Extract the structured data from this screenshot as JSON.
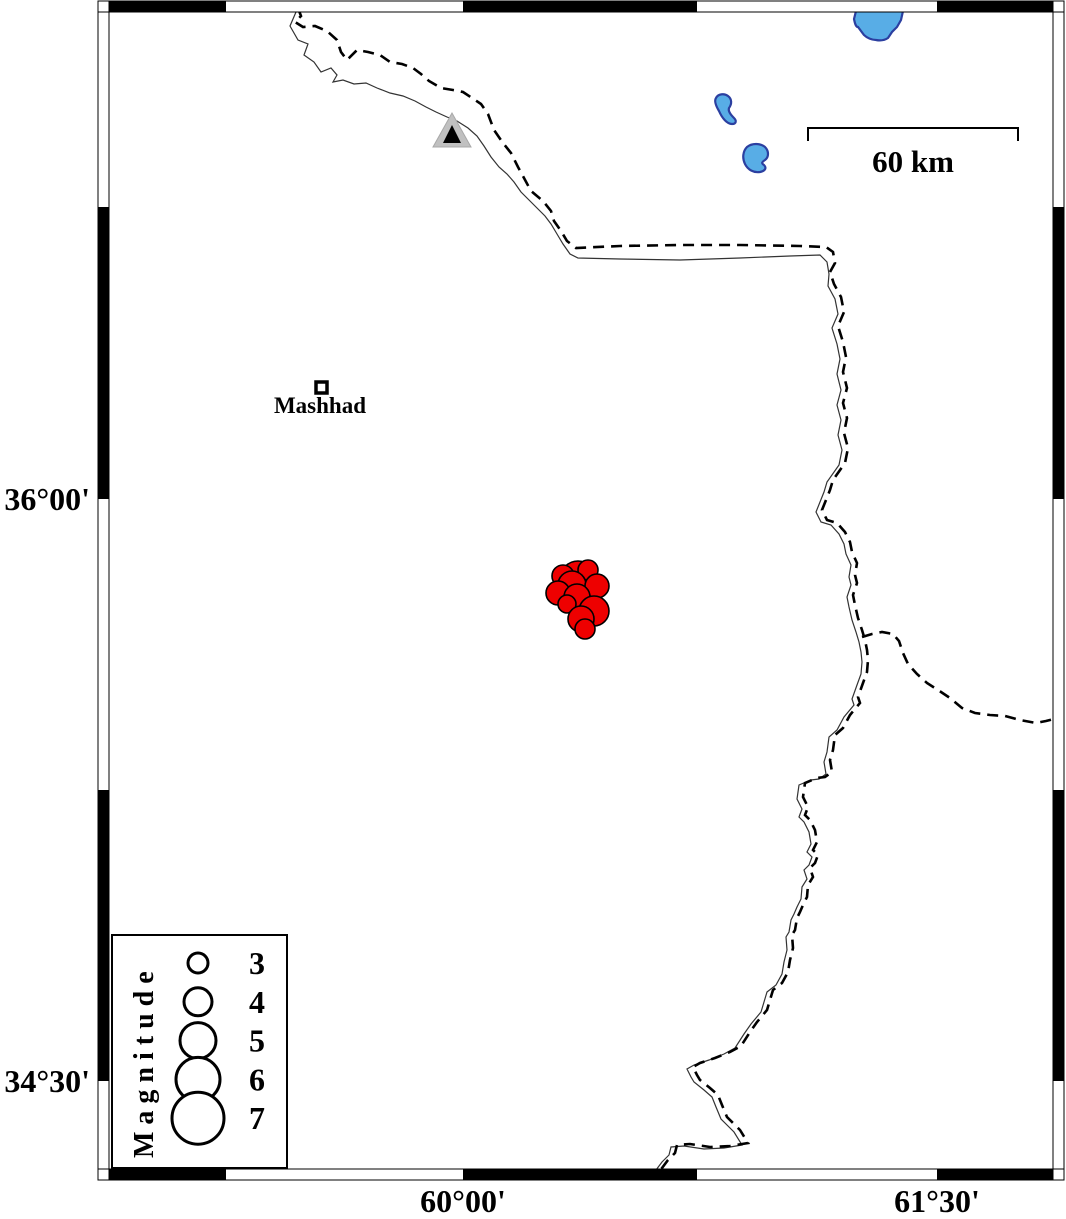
{
  "axis": {
    "latitude_labels": [
      {
        "text": "36°00'",
        "y": 499
      },
      {
        "text": "34°30'",
        "y": 1081
      }
    ],
    "longitude_labels": [
      {
        "text": "60°00'",
        "x": 463
      },
      {
        "text": "61°30'",
        "x": 937
      }
    ]
  },
  "city": {
    "label": "Mashhad"
  },
  "scale_bar": {
    "label": "60 km"
  },
  "legend": {
    "title": "Magnitude",
    "entries": [
      {
        "magnitude": "3",
        "radius": 10
      },
      {
        "magnitude": "4",
        "radius": 14
      },
      {
        "magnitude": "5",
        "radius": 18
      },
      {
        "magnitude": "6",
        "radius": 22
      },
      {
        "magnitude": "7",
        "radius": 26
      }
    ]
  },
  "colors": {
    "earthquake_fill": "#ee0000",
    "lake_fill": "#58ade6",
    "lake_outline": "#2b3fa0",
    "station_fill": "#c0c0c0",
    "frame_black": "#000000"
  },
  "earthquakes": [
    {
      "x": 578,
      "y": 579,
      "r": 18
    },
    {
      "x": 563,
      "y": 576,
      "r": 11
    },
    {
      "x": 588,
      "y": 570,
      "r": 10
    },
    {
      "x": 572,
      "y": 585,
      "r": 14
    },
    {
      "x": 597,
      "y": 586,
      "r": 12
    },
    {
      "x": 558,
      "y": 593,
      "r": 12
    },
    {
      "x": 577,
      "y": 597,
      "r": 13
    },
    {
      "x": 567,
      "y": 604,
      "r": 9
    },
    {
      "x": 594,
      "y": 611,
      "r": 15
    },
    {
      "x": 581,
      "y": 619,
      "r": 13
    },
    {
      "x": 585,
      "y": 629,
      "r": 10
    }
  ]
}
